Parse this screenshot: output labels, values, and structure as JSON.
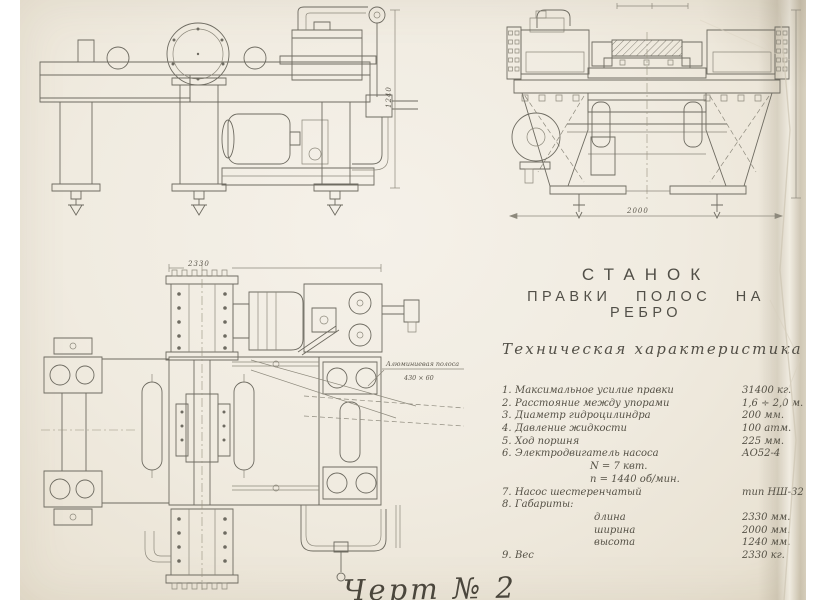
{
  "colors": {
    "paper": "#f0ebe0",
    "ink": "#6e6b61",
    "text": "#3c3a33"
  },
  "title": {
    "line1": "СТАНОК",
    "line2": "ПРАВКИ ПОЛОС НА РЕБРО"
  },
  "specs": {
    "heading": "Техническая характеристика",
    "rows": [
      {
        "num": "1.",
        "label": "Максимальное усилие правки",
        "value": "31400 кг."
      },
      {
        "num": "2.",
        "label": "Расстояние между упорами",
        "value": "1,6 ÷ 2,0 м."
      },
      {
        "num": "3.",
        "label": "Диаметр гидроцилиндра",
        "value": "200 мм."
      },
      {
        "num": "4.",
        "label": "Давление жидкости",
        "value": "100 атм."
      },
      {
        "num": "5.",
        "label": "Ход поршня",
        "value": "225 мм."
      },
      {
        "num": "6.",
        "label": "Электродвигатель насоса",
        "value": "АО52-4"
      },
      {
        "num": "",
        "label": "N = 7 квт.",
        "value": ""
      },
      {
        "num": "",
        "label": "n = 1440 об/мин.",
        "value": ""
      },
      {
        "num": "7.",
        "label": "Насос шестеренчатый",
        "value": "тип НШ-32"
      },
      {
        "num": "8.",
        "label": "Габариты:",
        "value": ""
      },
      {
        "num": "",
        "label": "длина",
        "value": "2330 мм."
      },
      {
        "num": "",
        "label": "ширина",
        "value": "2000 мм."
      },
      {
        "num": "",
        "label": "высота",
        "value": "1240 мм."
      },
      {
        "num": "9.",
        "label": "Вес",
        "value": "2330 кг."
      }
    ]
  },
  "dimensions": {
    "side_height": "1240",
    "front_width": "2000",
    "plan_length": "2330"
  },
  "strip_label": {
    "line1": "Алюминиевая полоса",
    "line2": "430 × 60"
  },
  "caption": "Черт № 2"
}
